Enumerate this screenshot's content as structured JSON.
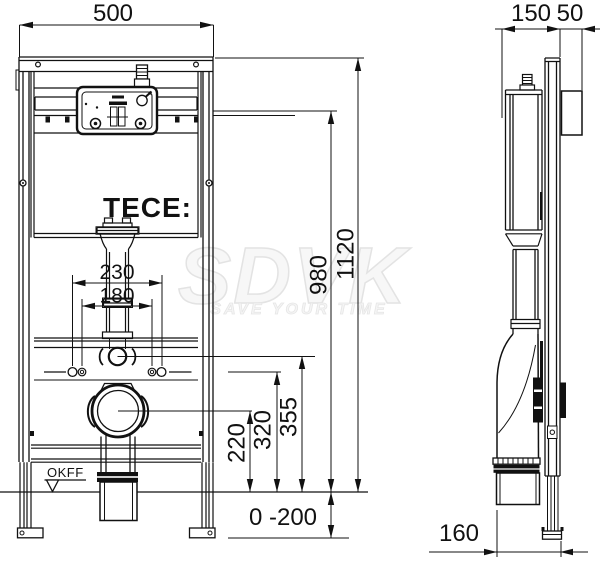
{
  "brand": {
    "logo": "TECE:"
  },
  "watermark": {
    "name": "SDVK",
    "slogan": "SAVE YOUR TIME"
  },
  "front_view": {
    "dim_width": "500",
    "dim_bolt_outer": "230",
    "dim_bolt_inner": "180",
    "dim_h220": "220",
    "dim_h320": "320",
    "dim_h355": "355",
    "dim_h980": "980",
    "dim_h1120": "1120",
    "dim_foot_range": "0 -200",
    "floor_label": "OKFF"
  },
  "side_view": {
    "dim_depth": "150",
    "dim_wall_offset": "50",
    "dim_outlet_distance": "160"
  }
}
